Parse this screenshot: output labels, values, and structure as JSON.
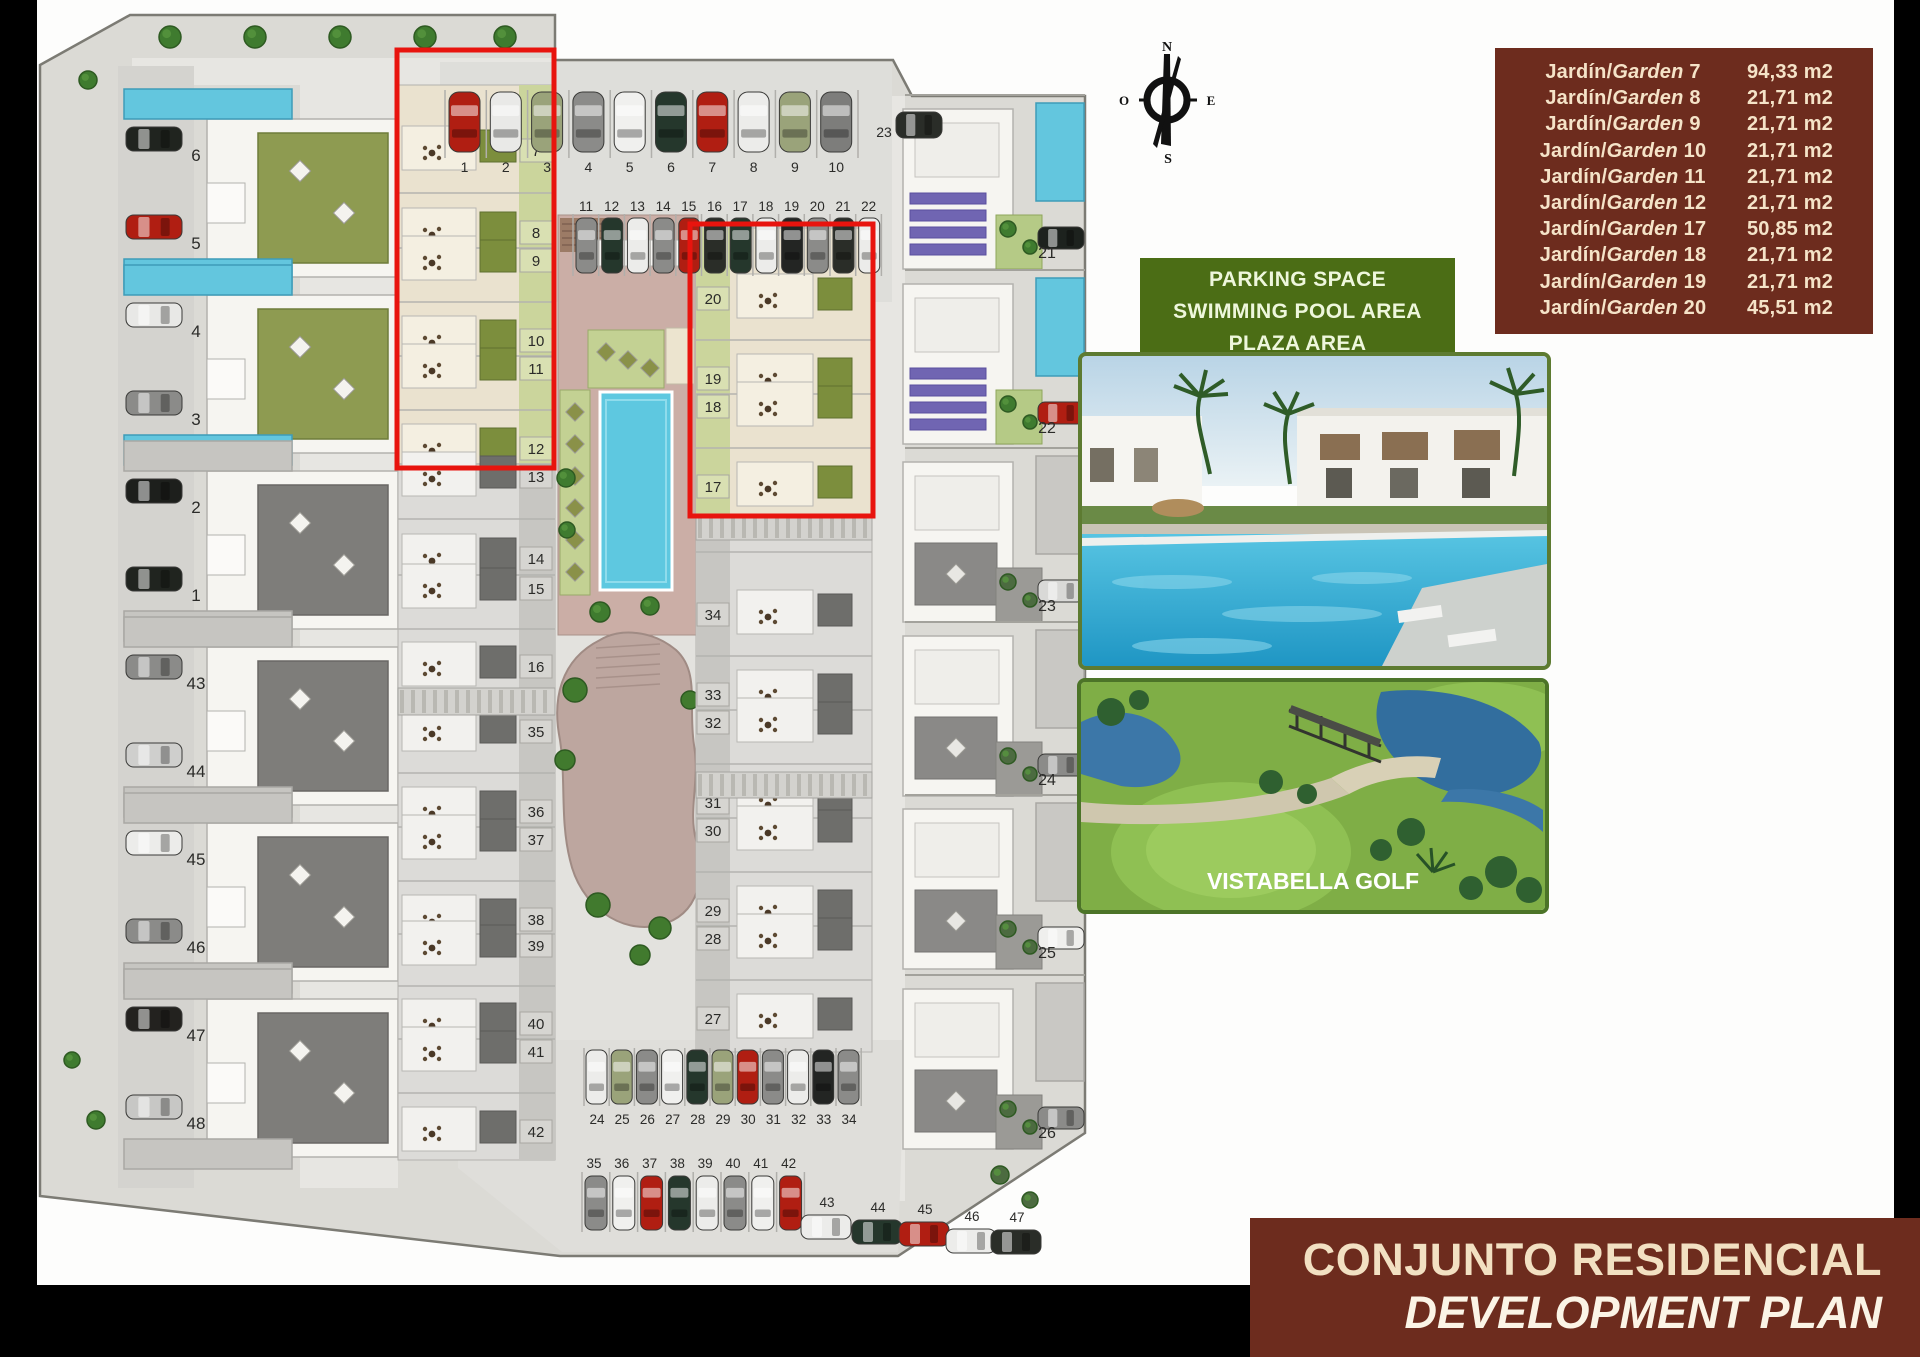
{
  "legend": {
    "jardin_prefix": "Jardín/",
    "garden_word": "Garden",
    "rows": [
      {
        "num": "7",
        "area": "94,33 m2"
      },
      {
        "num": "8",
        "area": "21,71 m2"
      },
      {
        "num": "9",
        "area": "21,71 m2"
      },
      {
        "num": "10",
        "area": "21,71 m2"
      },
      {
        "num": "11",
        "area": "21,71 m2"
      },
      {
        "num": "12",
        "area": "21,71 m2"
      },
      {
        "num": "17",
        "area": "50,85 m2"
      },
      {
        "num": "18",
        "area": "21,71 m2"
      },
      {
        "num": "19",
        "area": "21,71 m2"
      },
      {
        "num": "20",
        "area": "45,51 m2"
      }
    ],
    "bg": "#6d2c1e",
    "fg": "#f5e3c8"
  },
  "amenities": {
    "lines": [
      "PARKING SPACE",
      "SWIMMING POOL AREA",
      "PLAZA AREA",
      "CHILDREN'S PLAYGROUND"
    ],
    "bg": "#4b6d15",
    "fg": "#eef7dc"
  },
  "compass": {
    "north": "N",
    "south": "S",
    "east": "E",
    "west": "O"
  },
  "banner": {
    "title": "CONJUNTO RESIDENCIAL",
    "subtitle": "DEVELOPMENT PLAN",
    "bg": "#6d2c1e",
    "fg_title": "#f2e0c2",
    "fg_subtitle": "#fbf4e6"
  },
  "golf_photo": {
    "caption": "VISTABELLA GOLF"
  },
  "plan": {
    "left_lot_numbers": [
      "6",
      "5",
      "4",
      "3",
      "2",
      "1",
      "43",
      "44",
      "45",
      "46",
      "47",
      "48"
    ],
    "middle_lot_numbers": [
      "7",
      "8",
      "9",
      "10",
      "11",
      "12",
      "13",
      "14",
      "15",
      "16",
      "35",
      "36",
      "37",
      "38",
      "39",
      "40",
      "41",
      "42"
    ],
    "right_strip_numbers": [
      "20",
      "19",
      "18",
      "17",
      "34",
      "33",
      "32",
      "31",
      "30",
      "29",
      "28",
      "27"
    ],
    "villa_numbers": [
      "21",
      "22",
      "23",
      "24",
      "25",
      "26"
    ],
    "parking_row_top_a": [
      "1",
      "2",
      "3",
      "4",
      "5",
      "6",
      "7",
      "8",
      "9",
      "10"
    ],
    "parking_row_top_b": [
      "11",
      "12",
      "13",
      "14",
      "15",
      "16",
      "17",
      "18",
      "19",
      "20",
      "21",
      "22"
    ],
    "parking_single": "23",
    "parking_row_bottom_a": [
      "24",
      "25",
      "26",
      "27",
      "28",
      "29",
      "30",
      "31",
      "32",
      "33",
      "34"
    ],
    "parking_row_bottom_b": [
      "35",
      "36",
      "37",
      "38",
      "39",
      "40",
      "41",
      "42"
    ],
    "parking_diagonal": [
      "43",
      "44",
      "45",
      "46",
      "47"
    ]
  }
}
